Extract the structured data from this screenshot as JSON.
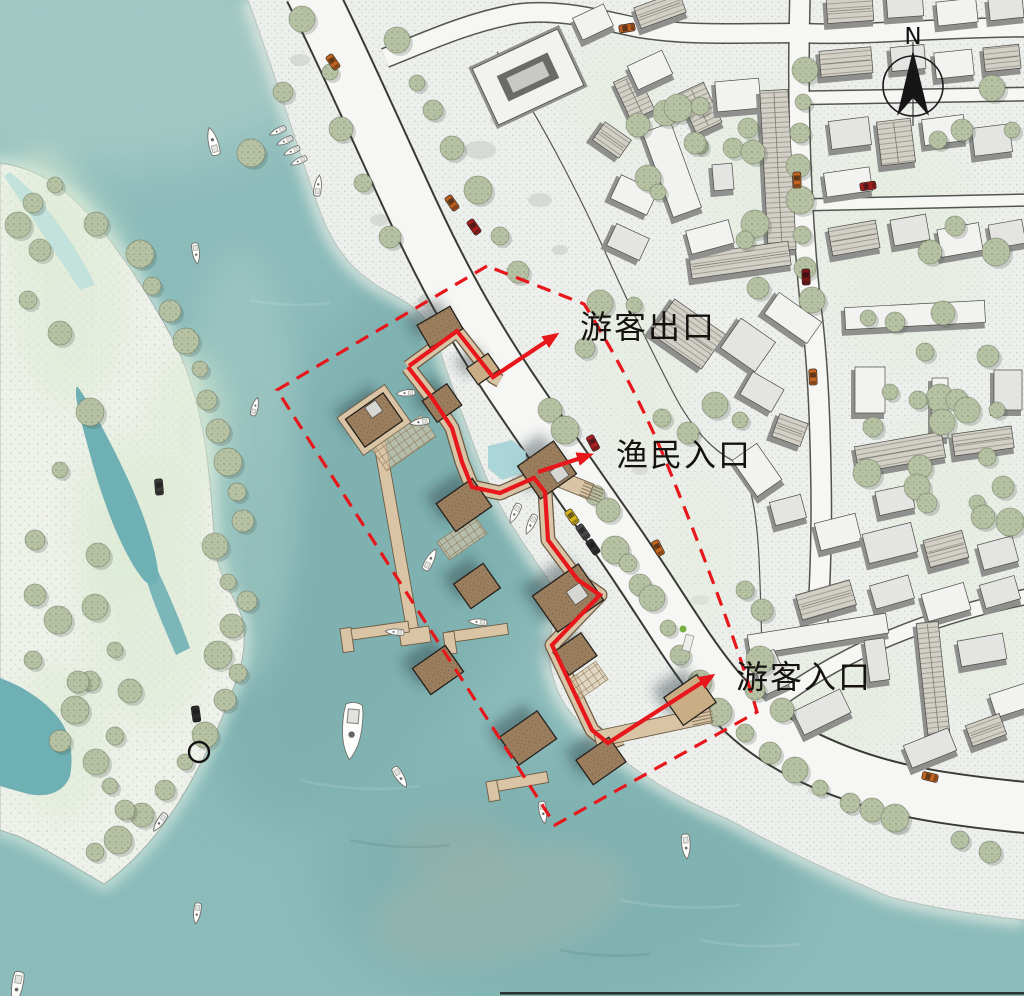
{
  "plan": {
    "kind": "waterfront fishing-pier master plan",
    "view": "top-down site plan"
  },
  "annotations": {
    "tourist_exit": "游客出口",
    "fisherman_entrance": "渔民入口",
    "tourist_entrance": "游客入口"
  },
  "compass": {
    "label": "N"
  },
  "palette": {
    "water": "#8cbcba",
    "water_deep": "#72a7a7",
    "water_light": "#a9cbc6",
    "lagoon": "#6fb0b4",
    "shallow": "#bfe0dc",
    "island_land": "#eef1ea",
    "beach": "#ecefec",
    "road": "#f6f7f4",
    "road_edge": "#3a3a35",
    "roof_light": "#e4e5e2",
    "roof_white": "#f2f2f0",
    "roof_hatch": "#d2cfc7",
    "building_mass": "#8f908e",
    "pier_wood": "#d9c5a5",
    "pier_roof": "#9b7e5e",
    "skylight": "#d6d6d3",
    "tree": "#b7c1a4",
    "route_red": "#e7171c",
    "north": "#161616"
  }
}
